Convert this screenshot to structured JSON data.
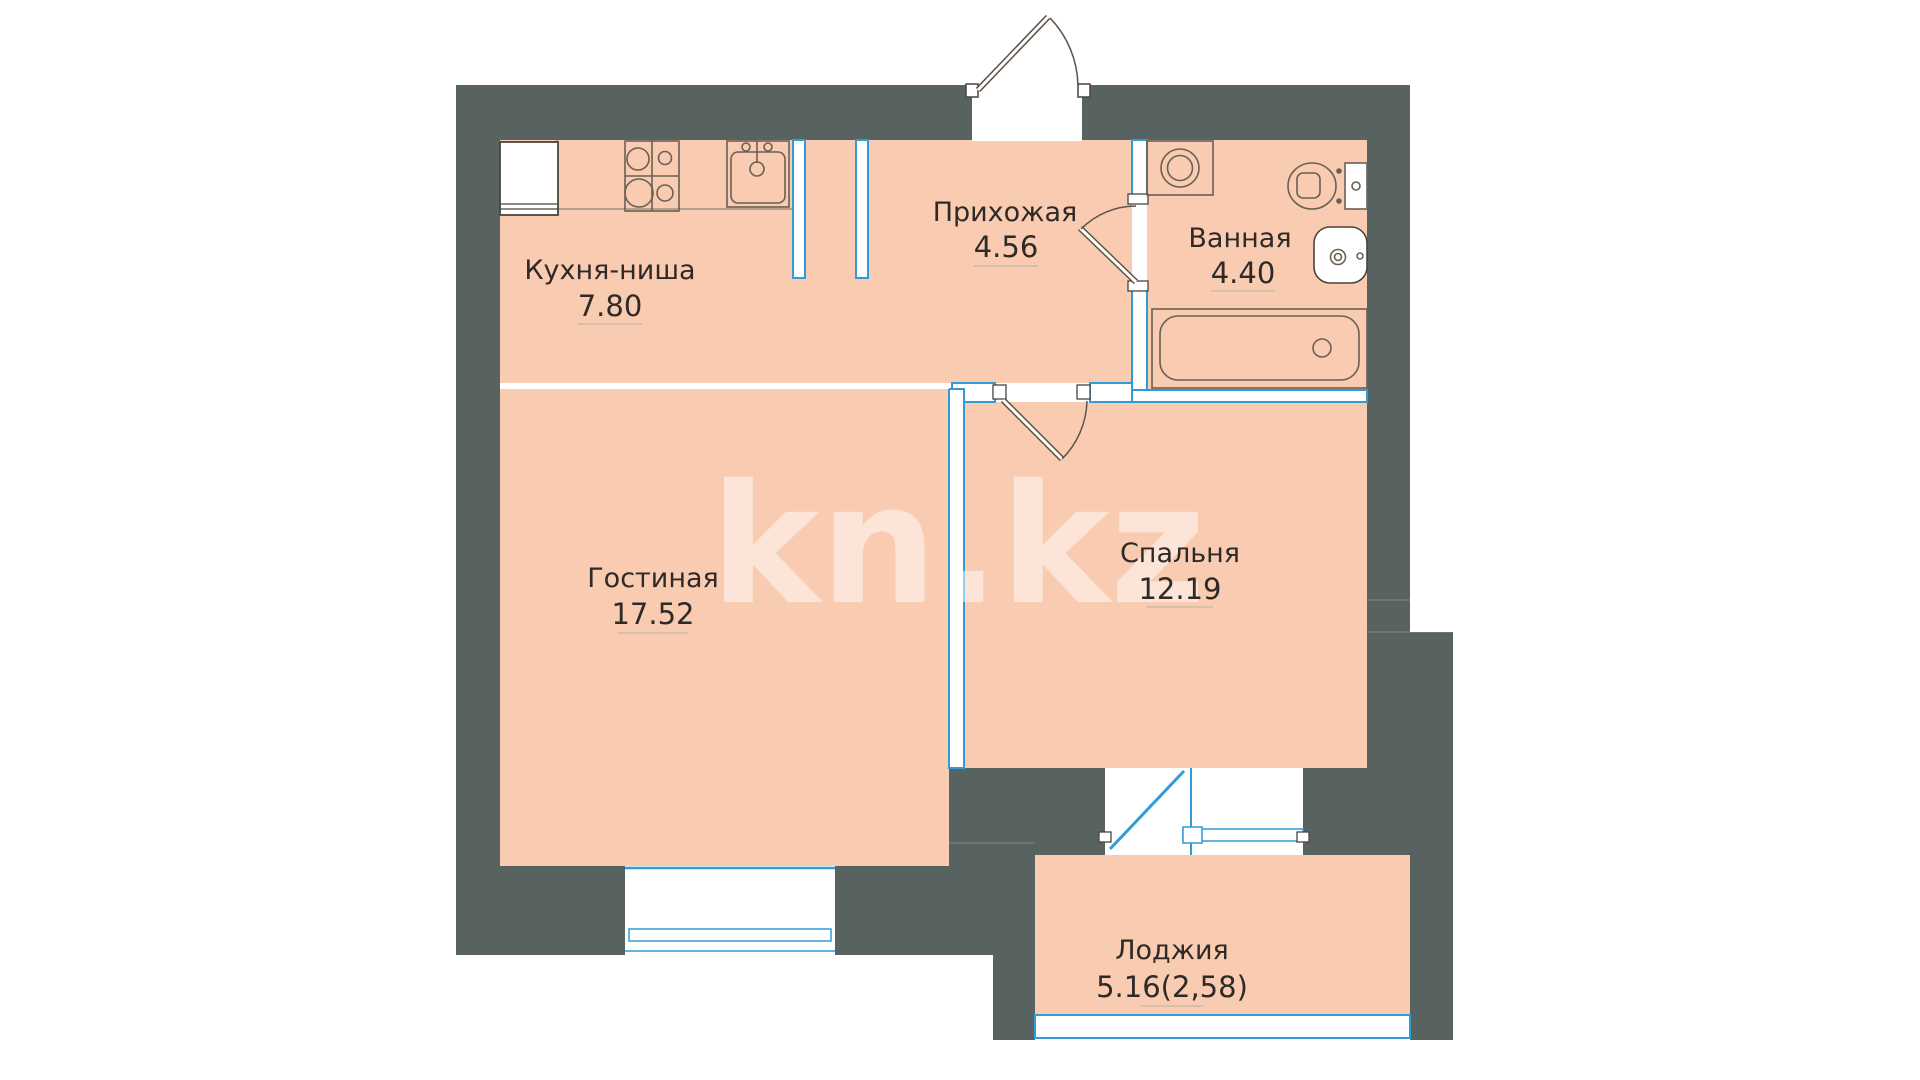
{
  "watermark": {
    "text": "kn.kz"
  },
  "rooms": {
    "kitchen": {
      "name": "Кухня-ниша",
      "area": "7.80"
    },
    "hallway": {
      "name": "Прихожая",
      "area": "4.56"
    },
    "bathroom": {
      "name": "Ванная",
      "area": "4.40"
    },
    "living": {
      "name": "Гостиная",
      "area": "17.52"
    },
    "bedroom": {
      "name": "Спальня",
      "area": "12.19"
    },
    "loggia": {
      "name": "Лоджия",
      "area": "5.16(2,58)"
    }
  },
  "fixtures": [
    "fridge-icon",
    "stove-icon",
    "kitchen-sink-icon",
    "washing-machine-icon",
    "toilet-icon",
    "wash-basin-icon",
    "bathtub-icon"
  ],
  "openings": [
    "entrance-door",
    "bathroom-door",
    "bedroom-door",
    "balcony-door-window",
    "living-room-window",
    "loggia-window"
  ],
  "colors": {
    "wall": "#586260",
    "floor": "#f9cbb1",
    "accent_blue": "#2f9cd6",
    "fixture_line": "#6a6054",
    "label_text": "#2e2a28",
    "underline": "#cdbbaa"
  }
}
